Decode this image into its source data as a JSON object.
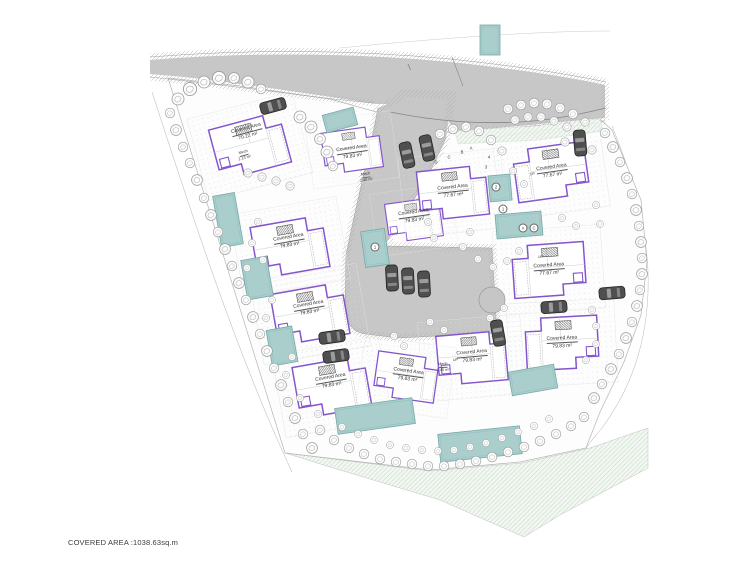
{
  "page": {
    "footer": "COVERED AREA :1038.63sq.m"
  },
  "plan": {
    "houses": [
      {
        "label": "Covered Area",
        "area": "70.22 m²"
      },
      {
        "label": "Covered Area",
        "area": "79.83 m²"
      },
      {
        "label": "Covered Area",
        "area": "79.83 m²"
      },
      {
        "label": "Covered Area",
        "area": "79.83 m²"
      },
      {
        "label": "Covered Area",
        "area": "79.83 m²"
      },
      {
        "label": "Covered Area",
        "area": "79.83 m²"
      },
      {
        "label": "Covered Area",
        "area": "77.67 m²"
      },
      {
        "label": "Covered Area",
        "area": "77.67 m²"
      },
      {
        "label": "Covered Area",
        "area": "77.67 m²"
      },
      {
        "label": "Covered Area",
        "area": "79.83 m²"
      },
      {
        "label": "Covered Area",
        "area": "79.83 m²"
      },
      {
        "label": "Covered Area",
        "area": "79.83 m²"
      }
    ],
    "mech_labels": [
      {
        "label": "Mech",
        "area": "2.13 m²"
      },
      {
        "label": "Mech",
        "area": "2.40 m²"
      },
      {
        "label": "Mech",
        "area": "2.40 m²"
      }
    ],
    "markers": [
      {
        "text": "D"
      },
      {
        "text": "C"
      },
      {
        "text": "B"
      },
      {
        "text": "A"
      },
      {
        "text": "4"
      },
      {
        "text": "3"
      },
      {
        "text": "2"
      },
      {
        "text": "1"
      },
      {
        "text": "1"
      },
      {
        "text": "A"
      },
      {
        "text": "C"
      }
    ],
    "up_labels": [
      {
        "text": "UP"
      },
      {
        "text": "UP"
      },
      {
        "text": "UP"
      }
    ],
    "colors": {
      "building_outline": "#8455cc",
      "pool_fill": "#a9cecc",
      "road_fill": "#c7c7c7",
      "landscape_hatch": "#c5d8c5"
    }
  }
}
